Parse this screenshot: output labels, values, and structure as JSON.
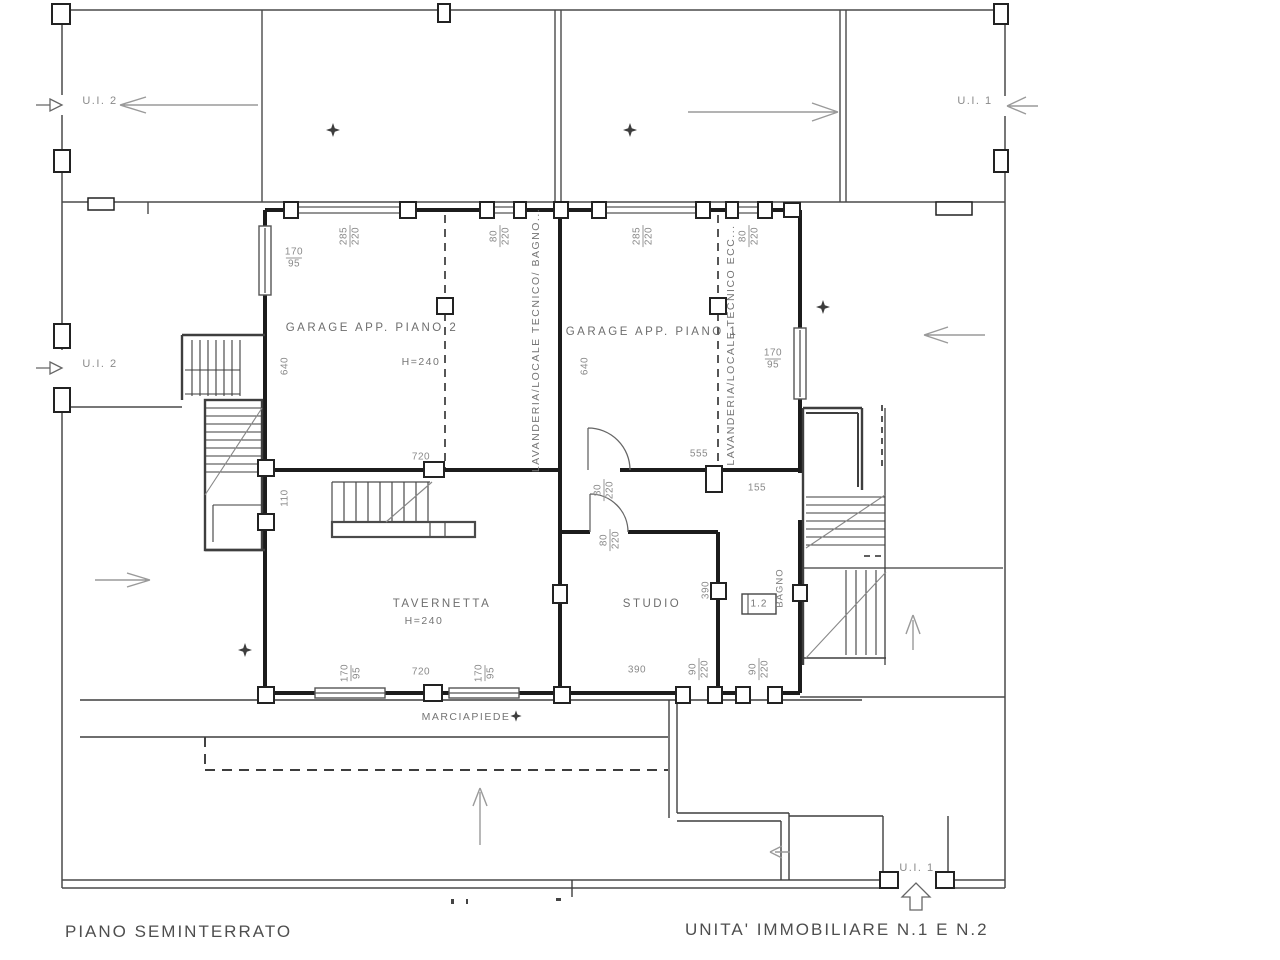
{
  "titles": {
    "floor": "PIANO SEMINTERRATO",
    "units": "UNITA'  IMMOBILIARE  N.1  E  N.2"
  },
  "unit_labels": {
    "ui2_top": "U.I. 2",
    "ui1_top": "U.I. 1",
    "ui2_side": "U.I. 2",
    "ui1_bottom": "U.I. 1"
  },
  "rooms": {
    "garage2": "GARAGE APP. PIANO 2",
    "garage2_h": "H=240",
    "garage1": "GARAGE APP. PIANO 1",
    "laundry2": "LAVANDERIA/LOCALE TECNICO/ BAGNO...",
    "laundry1": "LAVANDERIA/LOCALE TECNICO ECC...",
    "tavernetta": "TAVERNETTA",
    "tavernetta_h": "H=240",
    "studio": "STUDIO",
    "bagno": "BAGNO",
    "marciapiede": "MARCIAPIEDE",
    "fixture": "1.2"
  },
  "dims": {
    "g2_top_win": {
      "a": "285",
      "b": "220"
    },
    "mid_top_door": {
      "a": "80",
      "b": "220"
    },
    "g1_top_win": {
      "a": "285",
      "b": "220"
    },
    "right_top_door": {
      "a": "80",
      "b": "220"
    },
    "g2_left_win": {
      "a": "170",
      "b": "95"
    },
    "g2_left_len": "640",
    "g1_left_len": "640",
    "g1_right_win": {
      "a": "170",
      "b": "95"
    },
    "g2_width": "720",
    "corr_len": "555",
    "corr_w": "155",
    "door1": {
      "a": "80",
      "b": "220"
    },
    "door2": {
      "a": "80",
      "b": "220"
    },
    "wall_seg": "110",
    "studio_side": "390",
    "tav_win_l": {
      "a": "170",
      "b": "95"
    },
    "tav_width": "720",
    "tav_win_r": {
      "a": "170",
      "b": "95"
    },
    "studio_width": "390",
    "bot_door1": {
      "a": "90",
      "b": "220"
    },
    "bot_door2": {
      "a": "90",
      "b": "220"
    }
  }
}
